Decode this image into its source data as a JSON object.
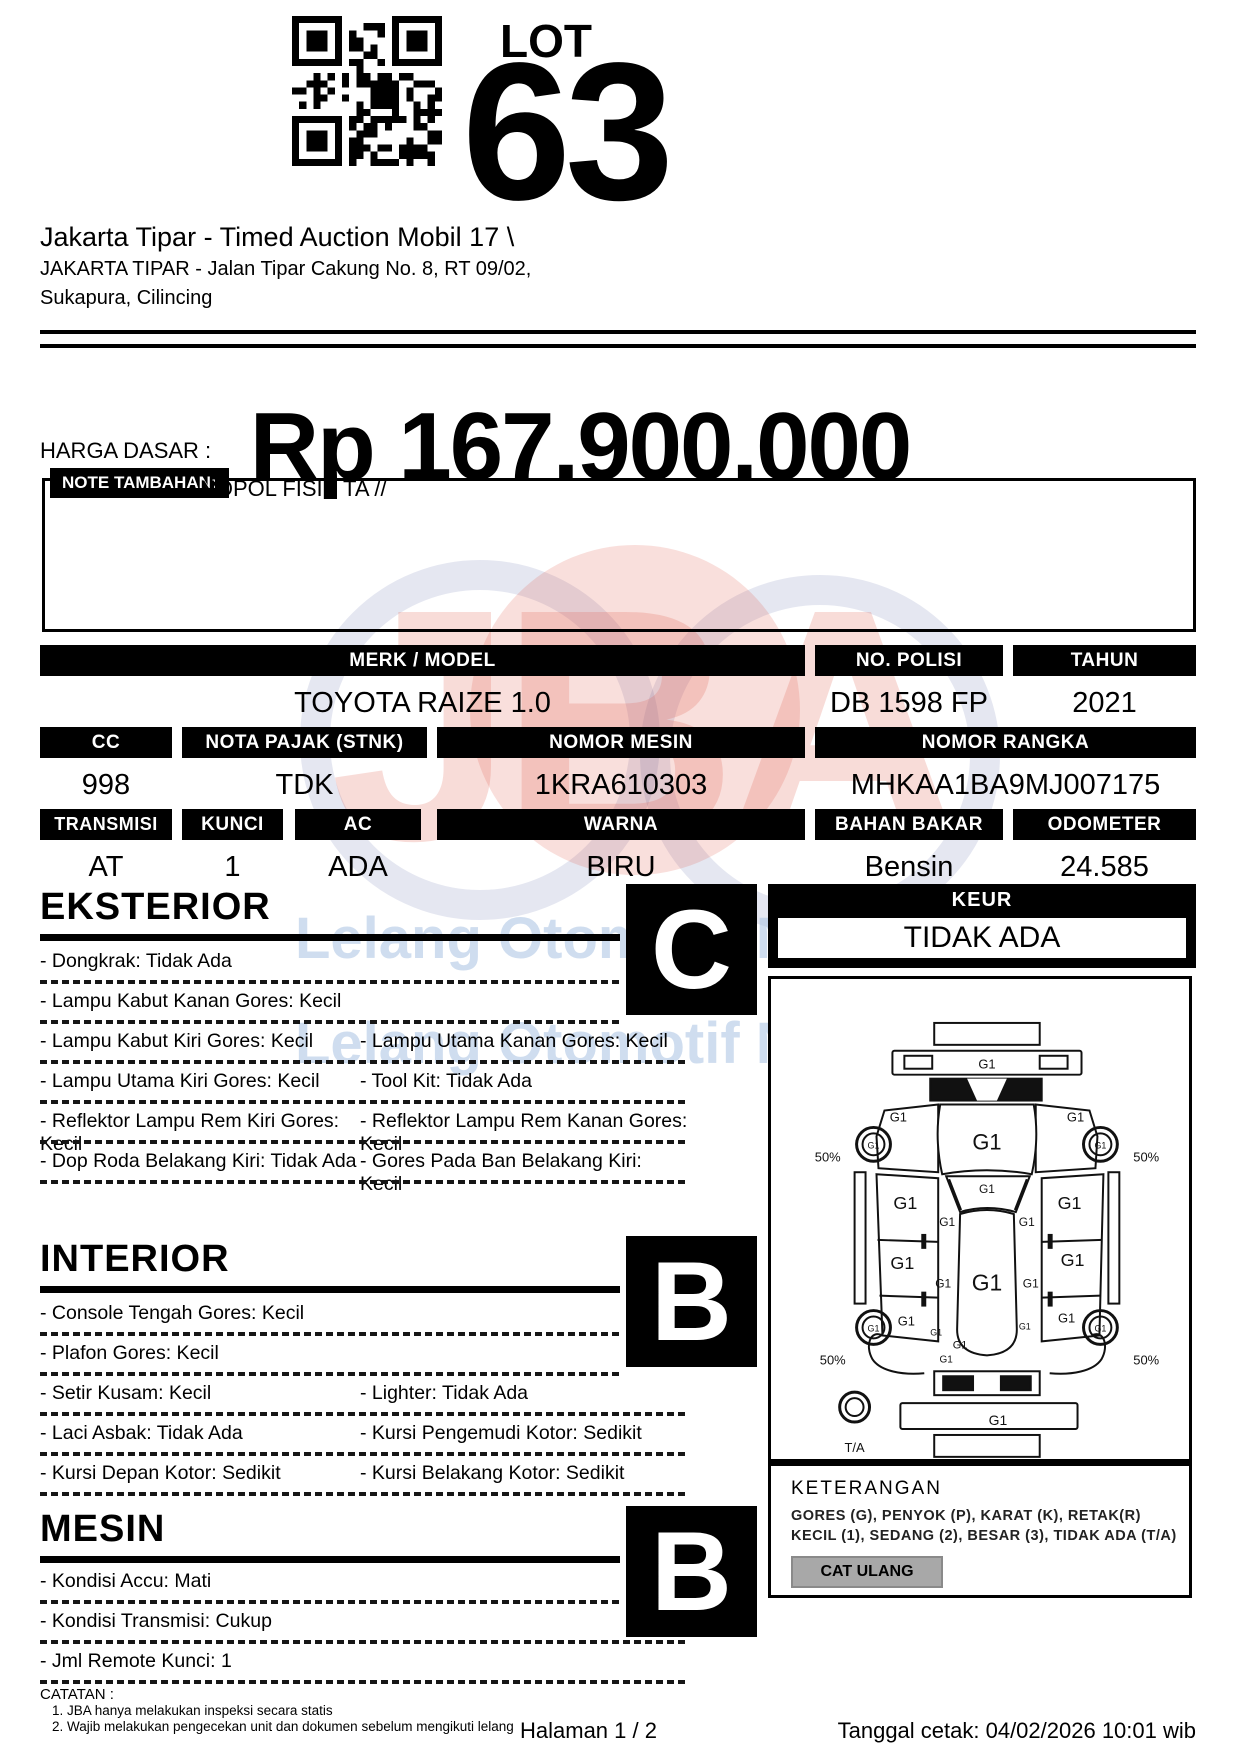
{
  "header": {
    "lot_label": "LOT",
    "lot_number": "63",
    "auction_title": "Jakarta Tipar - Timed Auction Mobil 17 \\",
    "location_line1": "JAKARTA TIPAR - Jalan Tipar Cakung No. 8, RT 09/02,",
    "location_line2": "Sukapura, Cilincing"
  },
  "price": {
    "label": "HARGA DASAR :",
    "value": "Rp 167.900.000"
  },
  "note": {
    "label": "NOTE TAMBAHAN:",
    "text": "NOPOL FISIK TA //"
  },
  "specs": {
    "merk_model": {
      "label": "MERK / MODEL",
      "value": "TOYOTA RAIZE 1.0"
    },
    "no_polisi": {
      "label": "NO. POLISI",
      "value": "DB 1598 FP"
    },
    "tahun": {
      "label": "TAHUN",
      "value": "2021"
    },
    "cc": {
      "label": "CC",
      "value": "998"
    },
    "nota_pajak": {
      "label": "NOTA PAJAK (STNK)",
      "value": "TDK"
    },
    "nomor_mesin": {
      "label": "NOMOR MESIN",
      "value": "1KRA610303"
    },
    "nomor_rangka": {
      "label": "NOMOR RANGKA",
      "value": "MHKAA1BA9MJ007175"
    },
    "transmisi": {
      "label": "TRANSMISI",
      "value": "AT"
    },
    "kunci": {
      "label": "KUNCI",
      "value": "1"
    },
    "ac": {
      "label": "AC",
      "value": "ADA"
    },
    "warna": {
      "label": "WARNA",
      "value": "BIRU"
    },
    "bahan_bakar": {
      "label": "BAHAN BAKAR",
      "value": "Bensin"
    },
    "odometer": {
      "label": "ODOMETER",
      "value": "24.585"
    }
  },
  "sections": {
    "eksterior": {
      "title": "EKSTERIOR",
      "grade": "C",
      "rows": [
        [
          "- Dongkrak: Tidak Ada",
          ""
        ],
        [
          "- Lampu Kabut Kanan Gores: Kecil",
          ""
        ],
        [
          "- Lampu Kabut Kiri Gores: Kecil",
          "- Lampu Utama Kanan Gores: Kecil"
        ],
        [
          "- Lampu Utama Kiri Gores: Kecil",
          "- Tool Kit: Tidak Ada"
        ],
        [
          "- Reflektor Lampu Rem Kiri Gores: Kecil",
          "- Reflektor Lampu Rem Kanan Gores: Kecil"
        ],
        [
          "- Dop Roda Belakang Kiri: Tidak Ada",
          "- Gores Pada Ban Belakang Kiri: Kecil"
        ]
      ]
    },
    "interior": {
      "title": "INTERIOR",
      "grade": "B",
      "rows": [
        [
          "- Console Tengah Gores: Kecil",
          ""
        ],
        [
          "- Plafon Gores: Kecil",
          ""
        ],
        [
          "- Setir Kusam: Kecil",
          "- Lighter: Tidak Ada"
        ],
        [
          "- Laci Asbak: Tidak Ada",
          "- Kursi Pengemudi Kotor: Sedikit"
        ],
        [
          "- Kursi Depan Kotor: Sedikit",
          "- Kursi Belakang Kotor: Sedikit"
        ]
      ]
    },
    "mesin": {
      "title": "MESIN",
      "grade": "B",
      "rows": [
        [
          "- Kondisi Accu: Mati",
          ""
        ],
        [
          "- Kondisi Transmisi: Cukup",
          ""
        ],
        [
          "- Jml Remote Kunci: 1",
          ""
        ]
      ]
    }
  },
  "keur": {
    "label": "KEUR",
    "value": "TIDAK ADA"
  },
  "diagram": {
    "marks": [
      {
        "t": "G1",
        "x": 217,
        "y": 90,
        "s": 13
      },
      {
        "t": "G1",
        "x": 128,
        "y": 143,
        "s": 13
      },
      {
        "t": "G1",
        "x": 306,
        "y": 143,
        "s": 13
      },
      {
        "t": "G1",
        "x": 217,
        "y": 171,
        "s": 22
      },
      {
        "t": "G1",
        "x": 103,
        "y": 170,
        "s": 9
      },
      {
        "t": "G1",
        "x": 331,
        "y": 170,
        "s": 9
      },
      {
        "t": "50%",
        "x": 57,
        "y": 183,
        "s": 13
      },
      {
        "t": "50%",
        "x": 377,
        "y": 183,
        "s": 13
      },
      {
        "t": "G1",
        "x": 135,
        "y": 231,
        "s": 18
      },
      {
        "t": "G1",
        "x": 300,
        "y": 231,
        "s": 18
      },
      {
        "t": "G1",
        "x": 217,
        "y": 215,
        "s": 12
      },
      {
        "t": "G1",
        "x": 177,
        "y": 248,
        "s": 12
      },
      {
        "t": "G1",
        "x": 257,
        "y": 248,
        "s": 12
      },
      {
        "t": "G1",
        "x": 132,
        "y": 291,
        "s": 18
      },
      {
        "t": "G1",
        "x": 303,
        "y": 288,
        "s": 18
      },
      {
        "t": "G1",
        "x": 217,
        "y": 313,
        "s": 23
      },
      {
        "t": "G1",
        "x": 173,
        "y": 310,
        "s": 12
      },
      {
        "t": "G1",
        "x": 261,
        "y": 310,
        "s": 12
      },
      {
        "t": "G1",
        "x": 136,
        "y": 348,
        "s": 13
      },
      {
        "t": "G1",
        "x": 297,
        "y": 345,
        "s": 13
      },
      {
        "t": "G1",
        "x": 103,
        "y": 354,
        "s": 9
      },
      {
        "t": "G1",
        "x": 331,
        "y": 354,
        "s": 9
      },
      {
        "t": "G1",
        "x": 166,
        "y": 358,
        "s": 9
      },
      {
        "t": "G1",
        "x": 255,
        "y": 352,
        "s": 9
      },
      {
        "t": "G1",
        "x": 190,
        "y": 371,
        "s": 11
      },
      {
        "t": "G1",
        "x": 176,
        "y": 385,
        "s": 10
      },
      {
        "t": "50%",
        "x": 62,
        "y": 387,
        "s": 13
      },
      {
        "t": "50%",
        "x": 377,
        "y": 387,
        "s": 13
      },
      {
        "t": "G1",
        "x": 228,
        "y": 448,
        "s": 14
      },
      {
        "t": "T/A",
        "x": 84,
        "y": 475,
        "s": 13
      }
    ]
  },
  "keterangan": {
    "title": "KETERANGAN",
    "line1": "GORES (G), PENYOK (P), KARAT (K), RETAK(R)",
    "line2": "KECIL (1), SEDANG (2), BESAR (3), TIDAK ADA (T/A)",
    "button": "CAT ULANG"
  },
  "catatan": {
    "title": "CATATAN :",
    "items": [
      "1. JBA hanya melakukan inspeksi secara statis",
      "2. Wajib melakukan pengecekan unit dan dokumen sebelum mengikuti lelang"
    ]
  },
  "footer": {
    "page": "Halaman 1 / 2",
    "printed": "Tanggal cetak: 04/02/2026 10:01 wib"
  },
  "watermark": {
    "jba": "JBA",
    "tagline": "Lelang Otomotif No.1"
  }
}
